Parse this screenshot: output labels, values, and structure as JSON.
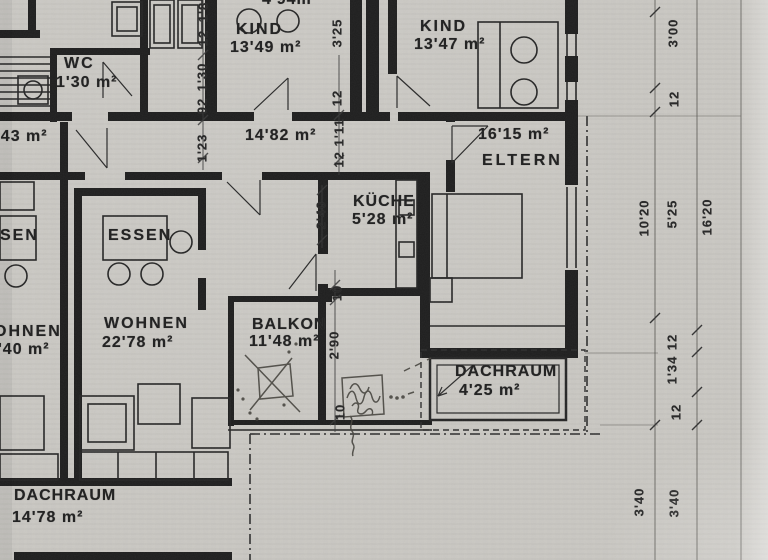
{
  "plan": {
    "partials": {
      "top_area": "4'94m",
      "left_area": "'43 m²"
    },
    "rooms": {
      "wc": {
        "name": "WC",
        "area": "1'30 m²"
      },
      "kind_left": {
        "name": "KIND",
        "area": "13'49 m²"
      },
      "kind_right": {
        "name": "KIND",
        "area": "13'47 m²"
      },
      "flur": {
        "area": "14'82 m²"
      },
      "eltern": {
        "name": "ELTERN",
        "area": "16'15 m²"
      },
      "kueche": {
        "name": "KÜCHE",
        "area": "5'28 m²"
      },
      "essen_left": {
        "name": "SEN"
      },
      "essen": {
        "name": "ESSEN"
      },
      "wohnen_left": {
        "name": "OHNEN",
        "area": "'40 m²"
      },
      "wohnen": {
        "name": "WOHNEN",
        "area": "22'78 m²"
      },
      "balkon": {
        "name": "BALKON",
        "area": "11'48 m²"
      },
      "dachraum_right": {
        "name": "DACHRAUM",
        "area": "4'25 m²"
      },
      "dachraum_bottom": {
        "name": "DACHRAUM",
        "area": "14'78 m²"
      }
    },
    "dims": {
      "left_chain": [
        "1'8",
        "12",
        "1'30",
        "92"
      ],
      "flur_left": "1'23",
      "hall_wall": "12",
      "hall_mid": "12 1'11",
      "kind_width": "3'25",
      "kueche_h": "2'40",
      "wall_top": "10",
      "balkon_h": "2'90",
      "wall_bottom": "10",
      "right": {
        "a": "3'00",
        "b": "12",
        "c": "10'20",
        "d": "5'25",
        "e": "16'20",
        "f": "12",
        "g": "1'34",
        "h": "12",
        "i": "3'40",
        "j": "3'40"
      }
    },
    "colors": {
      "paper": "#c9c7c2",
      "ink": "#1f1f1f",
      "pencil": "#46443e"
    }
  }
}
